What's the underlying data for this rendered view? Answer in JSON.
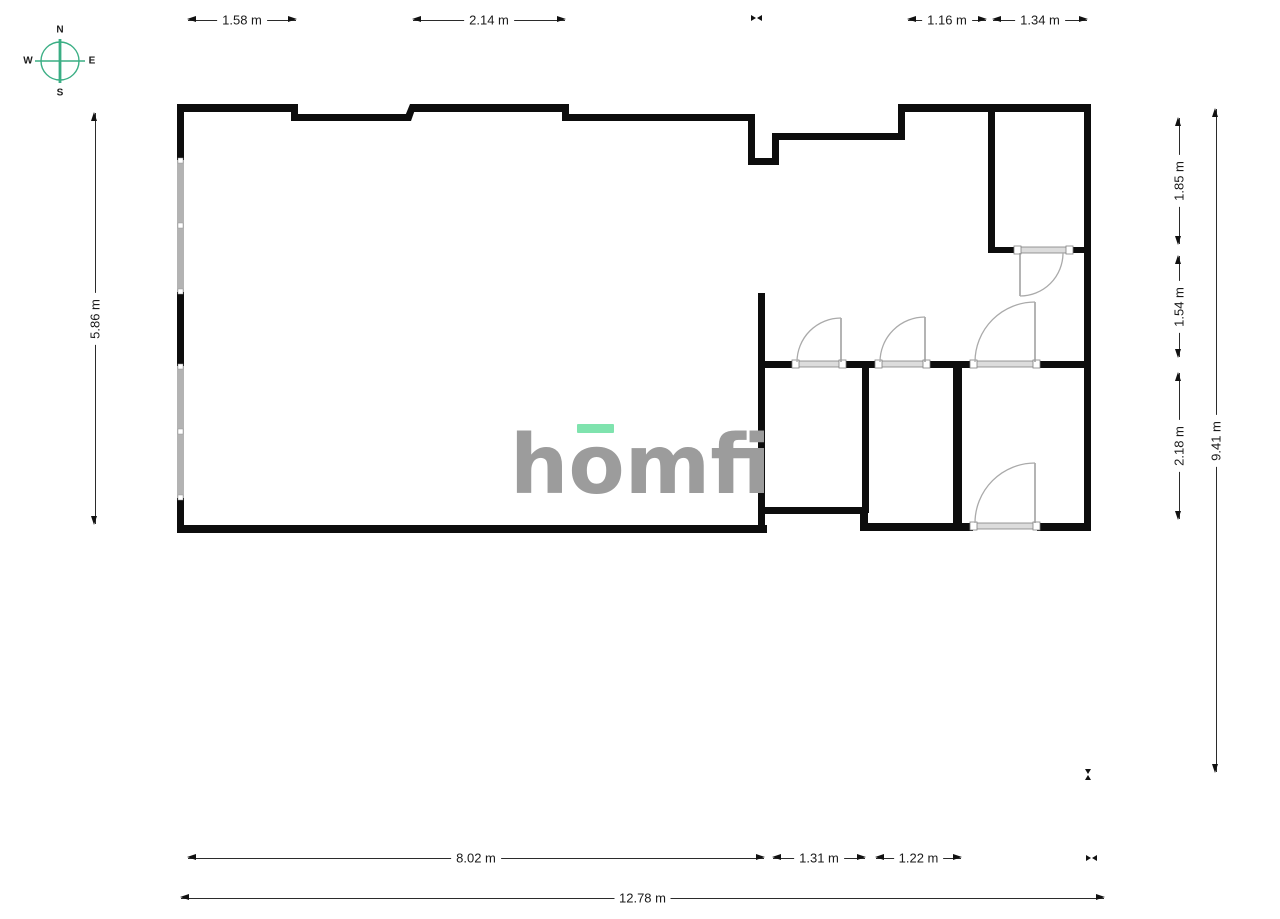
{
  "compass": {
    "north": "N",
    "south": "S",
    "east": "E",
    "west": "W"
  },
  "logo": {
    "part1": "h",
    "part2": "o",
    "part3": "mfi"
  },
  "dimensions": {
    "top": [
      {
        "label": "1.58 m"
      },
      {
        "label": "2.14 m"
      },
      {
        "label": "1.16 m"
      },
      {
        "label": "1.34 m"
      }
    ],
    "left": [
      {
        "label": "5.86 m"
      }
    ],
    "right": [
      {
        "label": "1.85 m"
      },
      {
        "label": "1.54 m"
      },
      {
        "label": "2.18 m"
      },
      {
        "label": "9.41 m"
      }
    ],
    "bottom": [
      {
        "label": "8.02 m"
      },
      {
        "label": "1.31 m"
      },
      {
        "label": "1.22 m"
      },
      {
        "label": "12.78 m"
      }
    ]
  },
  "colors": {
    "wall": "#0d0d0d",
    "window_glass": "#b3b3b3",
    "door_panel": "#dcdcdc",
    "swing_arc": "#aaaaaa",
    "compass_accent": "#3aae84",
    "logo_text": "#9c9c9c",
    "logo_accent": "#7fe3ae",
    "dimension_text": "#1a1a1a"
  }
}
